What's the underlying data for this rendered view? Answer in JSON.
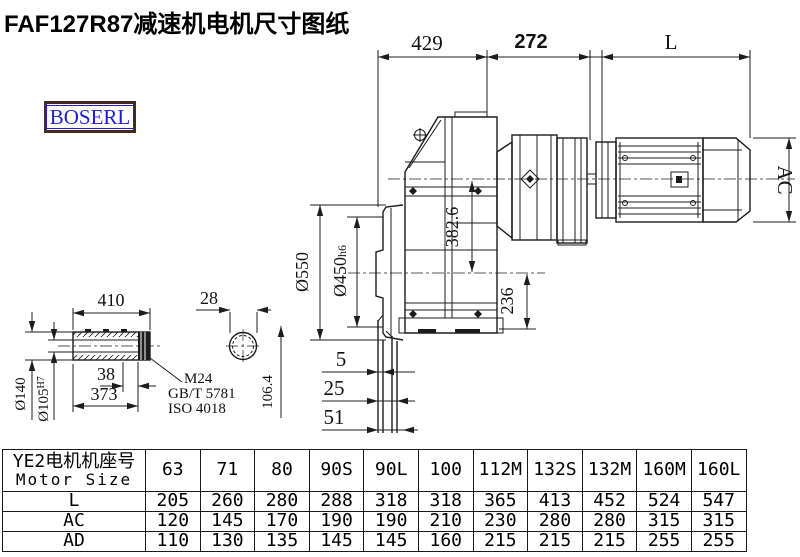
{
  "title": "FAF127R87减速机电机尺寸图纸",
  "logo": {
    "text": "BOSERL"
  },
  "colors": {
    "background": "#ffffff",
    "line": "#1c1c1c",
    "text": "#111111",
    "logo_text": "#1e1ecf",
    "logo_border": "#43291f"
  },
  "drawing": {
    "dim_429": "429",
    "dim_272": "272",
    "dim_L": "L",
    "dim_AC": "AC",
    "dia_550": "Ø550",
    "dia_450": "Ø450",
    "dia_450_tol": "h6",
    "dim_382_6": "382.6",
    "dim_236": "236",
    "dim_410": "410",
    "dim_28": "28",
    "dia_140": "Ø140",
    "dia_105": "Ø105",
    "dia_105_tol": "H7",
    "dim_38": "38",
    "dim_373": "373",
    "thread_label": "M24",
    "thread_std_1": "GB/T 5781",
    "thread_std_2": "ISO 4018",
    "dim_106_4": "106.4",
    "dim_5": "5",
    "dim_25": "25",
    "dim_51": "51"
  },
  "table": {
    "header_cn": "YE2电机机座号",
    "header_en": "Motor Size",
    "columns": [
      "63",
      "71",
      "80",
      "90S",
      "90L",
      "100",
      "112M",
      "132S",
      "132M",
      "160M",
      "160L"
    ],
    "rows": [
      {
        "label": "L",
        "values": [
          "205",
          "260",
          "280",
          "288",
          "318",
          "318",
          "365",
          "413",
          "452",
          "524",
          "547"
        ]
      },
      {
        "label": "AC",
        "values": [
          "120",
          "145",
          "170",
          "190",
          "190",
          "210",
          "230",
          "280",
          "280",
          "315",
          "315"
        ]
      },
      {
        "label": "AD",
        "values": [
          "110",
          "130",
          "135",
          "145",
          "145",
          "160",
          "215",
          "215",
          "215",
          "255",
          "255"
        ]
      }
    ]
  }
}
